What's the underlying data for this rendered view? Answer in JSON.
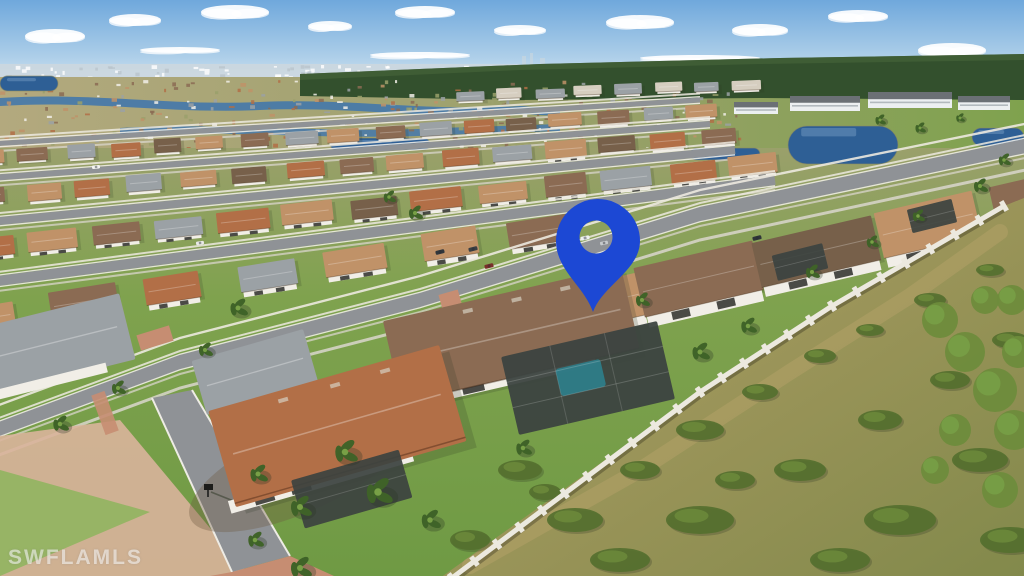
{
  "photo": {
    "description": "Aerial drone photo of a Florida residential community; rows of tile-roof homes, lakes, preserve at right, blue location pin marking the subject home",
    "width": 1024,
    "height": 576
  },
  "watermark": {
    "text": "SWFLAMLS"
  },
  "pin": {
    "label": "location-pin",
    "color": "#1c48d4",
    "cx": 598,
    "cy": 241,
    "r_outer": 42,
    "hole_cx": 596,
    "hole_cy": 237,
    "r_hole": 16.5,
    "tip_x": 593,
    "tip_y": 312
  },
  "palette": {
    "sky_top": "#6fa8dc",
    "sky_mid": "#aecfe9",
    "sky_horizon": "#e6eef3",
    "cloud": "#ffffff",
    "city": "#ccd7de",
    "city_speck_a": "#ffffff",
    "city_speck_b": "#b9c4cc",
    "forest": "#33502d",
    "forest_light": "#48663a",
    "dist_land": "#b3a97e",
    "dist_land2": "#9aa06b",
    "canal": "#4478ab",
    "lake": "#2e5f95",
    "lake_edge": "#8d8a60",
    "condo_wall": "#eceff1",
    "condo_roof": "#6b7075",
    "condo_win": "#9aa2a8",
    "street": "#8f9296",
    "street_far": "#a6a8aa",
    "curb": "#eeece5",
    "sidewalk": "#d9d6cc",
    "grass": "#7fa24e",
    "grass_light": "#97b465",
    "lawn": "#6f9a44",
    "roof_tan": "#c09268",
    "roof_brown": "#8b6b53",
    "roof_gray": "#9ba1a5",
    "roof_terra": "#b26f47",
    "roof_dark": "#77604a",
    "roof_light": "#d6cec0",
    "house_wall": "#f1eee7",
    "wall_white": "#ece9df",
    "window_dark": "#4a4a46",
    "lanai": "#3c4340",
    "pool": "#2e7f8c",
    "paver": "#c68d72",
    "paver_light": "#d9b49b",
    "preserve_tan": "#b3a067",
    "preserve_green": "#82894b",
    "bush": "#55702f",
    "bush2": "#6e8c3c",
    "palm": "#3f6328",
    "palm_light": "#78a046",
    "mulch": "#6d5a43",
    "mailbox": "#1d1d1b",
    "shadow": "#2c3524"
  },
  "scene": {
    "clouds": [
      {
        "x": 55,
        "y": 36,
        "rx": 30,
        "ry": 7
      },
      {
        "x": 135,
        "y": 20,
        "rx": 26,
        "ry": 6
      },
      {
        "x": 235,
        "y": 12,
        "rx": 34,
        "ry": 7
      },
      {
        "x": 330,
        "y": 26,
        "rx": 22,
        "ry": 5
      },
      {
        "x": 425,
        "y": 12,
        "rx": 30,
        "ry": 6
      },
      {
        "x": 520,
        "y": 30,
        "rx": 26,
        "ry": 5
      },
      {
        "x": 640,
        "y": 22,
        "rx": 34,
        "ry": 7
      },
      {
        "x": 760,
        "y": 30,
        "rx": 28,
        "ry": 6
      },
      {
        "x": 858,
        "y": 16,
        "rx": 30,
        "ry": 6
      },
      {
        "x": 952,
        "y": 50,
        "rx": 34,
        "ry": 7
      },
      {
        "x": 700,
        "y": 58,
        "rx": 60,
        "ry": 3
      },
      {
        "x": 420,
        "y": 55,
        "rx": 50,
        "ry": 3
      },
      {
        "x": 180,
        "y": 50,
        "rx": 40,
        "ry": 3
      },
      {
        "x": 880,
        "y": 64,
        "rx": 46,
        "ry": 3
      }
    ],
    "streets": [
      {
        "pts": [
          [
            -10,
            144
          ],
          [
            700,
            100
          ]
        ],
        "w": 5
      },
      {
        "pts": [
          [
            -10,
            178
          ],
          [
            710,
            124
          ]
        ],
        "w": 6
      },
      {
        "pts": [
          [
            -10,
            222
          ],
          [
            735,
            150
          ]
        ],
        "w": 8
      },
      {
        "pts": [
          [
            -10,
            282
          ],
          [
            775,
            180
          ]
        ],
        "w": 10
      },
      {
        "pts": [
          [
            -20,
            436
          ],
          [
            180,
            362
          ],
          [
            420,
            300
          ],
          [
            700,
            214
          ],
          [
            1044,
            142
          ]
        ],
        "w": 14
      }
    ],
    "rows": [
      {
        "x0": -10,
        "y0": 158,
        "x1": 700,
        "y1": 112,
        "n": 17,
        "w": 30,
        "h": 13,
        "colors": [
          "roof_tan",
          "roof_brown",
          "roof_gray",
          "roof_terra",
          "roof_dark",
          "roof_tan",
          "roof_brown",
          "roof_gray"
        ]
      },
      {
        "x0": -10,
        "y0": 196,
        "x1": 720,
        "y1": 136,
        "n": 15,
        "w": 36,
        "h": 16,
        "colors": [
          "roof_brown",
          "roof_tan",
          "roof_terra",
          "roof_gray",
          "roof_tan",
          "roof_dark",
          "roof_terra"
        ]
      },
      {
        "x0": -10,
        "y0": 248,
        "x1": 755,
        "y1": 165,
        "n": 13,
        "w": 46,
        "h": 20,
        "colors": [
          "roof_terra",
          "roof_tan",
          "roof_brown",
          "roof_gray",
          "roof_terra",
          "roof_tan",
          "roof_dark"
        ]
      },
      {
        "x0": -10,
        "y0": 318,
        "x1": 540,
        "y1": 230,
        "n": 7,
        "w": 60,
        "h": 27,
        "colors": [
          "roof_tan",
          "roof_brown",
          "roof_terra",
          "roof_gray",
          "roof_tan"
        ]
      },
      {
        "x0": 470,
        "y0": 332,
        "x1": 1044,
        "y1": 198,
        "n": 6,
        "w": 108,
        "h": 46,
        "colors": [
          "roof_brown",
          "roof_tan",
          "roof_brown",
          "roof_dark",
          "roof_tan",
          "roof_brown"
        ]
      }
    ],
    "gray_row": {
      "x0": 470,
      "y0": 96,
      "x1": 745,
      "y1": 85,
      "n": 8,
      "w": 26,
      "h": 10,
      "colors": [
        "roof_gray",
        "roof_light",
        "roof_gray",
        "roof_light"
      ]
    },
    "condos": [
      {
        "x": 790,
        "y": 96,
        "w": 70,
        "h": 15
      },
      {
        "x": 868,
        "y": 92,
        "w": 84,
        "h": 16
      },
      {
        "x": 958,
        "y": 96,
        "w": 52,
        "h": 14
      },
      {
        "x": 734,
        "y": 102,
        "w": 44,
        "h": 12
      }
    ],
    "lakes": [
      {
        "x": 0,
        "y": 76,
        "w": 58,
        "h": 15
      },
      {
        "x": 788,
        "y": 126,
        "w": 110,
        "h": 38
      },
      {
        "x": 972,
        "y": 128,
        "w": 52,
        "h": 18
      },
      {
        "x": 690,
        "y": 148,
        "w": 70,
        "h": 12
      },
      {
        "x": 330,
        "y": 138,
        "w": 100,
        "h": 12
      }
    ],
    "speckles": {
      "x0": 0,
      "x1": 745,
      "y0": 80,
      "y1": 148,
      "count": 300
    },
    "city_speckles": {
      "x0": 0,
      "x1": 520,
      "y0": 65,
      "y1": 77,
      "count": 80
    },
    "wall_pts": [
      [
        452,
        578
      ],
      [
        700,
        392
      ],
      [
        832,
        306
      ],
      [
        1004,
        206
      ]
    ],
    "preserve_pts": "440,578 700,392 832,306 1004,206 1024,198 1024,578",
    "sand_path_pts": "470,566 640,470 790,372 910,296 1000,232",
    "lanai_cages": [
      {
        "x": 800,
        "y": 262,
        "w": 52,
        "h": 26,
        "rot": -14
      },
      {
        "x": 932,
        "y": 216,
        "w": 46,
        "h": 24,
        "rot": -14
      }
    ],
    "bushes": [
      {
        "x": 520,
        "y": 470,
        "rx": 22,
        "ry": 10
      },
      {
        "x": 575,
        "y": 520,
        "rx": 28,
        "ry": 12
      },
      {
        "x": 640,
        "y": 470,
        "rx": 20,
        "ry": 9
      },
      {
        "x": 700,
        "y": 430,
        "rx": 24,
        "ry": 10
      },
      {
        "x": 760,
        "y": 392,
        "rx": 18,
        "ry": 8
      },
      {
        "x": 820,
        "y": 356,
        "rx": 16,
        "ry": 7
      },
      {
        "x": 870,
        "y": 330,
        "rx": 14,
        "ry": 6
      },
      {
        "x": 930,
        "y": 300,
        "rx": 16,
        "ry": 7
      },
      {
        "x": 990,
        "y": 270,
        "rx": 14,
        "ry": 6
      },
      {
        "x": 700,
        "y": 520,
        "rx": 34,
        "ry": 14
      },
      {
        "x": 800,
        "y": 470,
        "rx": 26,
        "ry": 11
      },
      {
        "x": 880,
        "y": 420,
        "rx": 22,
        "ry": 10
      },
      {
        "x": 950,
        "y": 380,
        "rx": 20,
        "ry": 9
      },
      {
        "x": 1010,
        "y": 340,
        "rx": 18,
        "ry": 8
      },
      {
        "x": 620,
        "y": 560,
        "rx": 30,
        "ry": 12
      },
      {
        "x": 900,
        "y": 520,
        "rx": 36,
        "ry": 15
      },
      {
        "x": 980,
        "y": 460,
        "rx": 28,
        "ry": 12
      },
      {
        "x": 1010,
        "y": 540,
        "rx": 30,
        "ry": 13
      },
      {
        "x": 840,
        "y": 560,
        "rx": 30,
        "ry": 12
      },
      {
        "x": 470,
        "y": 540,
        "rx": 20,
        "ry": 10
      },
      {
        "x": 545,
        "y": 492,
        "rx": 16,
        "ry": 8
      },
      {
        "x": 735,
        "y": 480,
        "rx": 20,
        "ry": 9
      }
    ],
    "trees": [
      {
        "x": 940,
        "y": 320,
        "r": 18
      },
      {
        "x": 965,
        "y": 352,
        "r": 20
      },
      {
        "x": 995,
        "y": 390,
        "r": 22
      },
      {
        "x": 1014,
        "y": 430,
        "r": 20
      },
      {
        "x": 985,
        "y": 300,
        "r": 14
      },
      {
        "x": 1012,
        "y": 300,
        "r": 15
      },
      {
        "x": 1018,
        "y": 352,
        "r": 16
      },
      {
        "x": 955,
        "y": 430,
        "r": 16
      },
      {
        "x": 935,
        "y": 470,
        "r": 14
      },
      {
        "x": 1000,
        "y": 490,
        "r": 18
      }
    ],
    "palms": [
      {
        "x": 238,
        "y": 308,
        "r": 10
      },
      {
        "x": 205,
        "y": 350,
        "r": 8
      },
      {
        "x": 415,
        "y": 213,
        "r": 8
      },
      {
        "x": 389,
        "y": 197,
        "r": 7
      },
      {
        "x": 345,
        "y": 452,
        "r": 13
      },
      {
        "x": 378,
        "y": 492,
        "r": 15
      },
      {
        "x": 300,
        "y": 507,
        "r": 12
      },
      {
        "x": 258,
        "y": 474,
        "r": 10
      },
      {
        "x": 430,
        "y": 520,
        "r": 11
      },
      {
        "x": 523,
        "y": 448,
        "r": 9
      },
      {
        "x": 700,
        "y": 352,
        "r": 10
      },
      {
        "x": 748,
        "y": 326,
        "r": 9
      },
      {
        "x": 642,
        "y": 300,
        "r": 8
      },
      {
        "x": 812,
        "y": 272,
        "r": 8
      },
      {
        "x": 872,
        "y": 242,
        "r": 7
      },
      {
        "x": 918,
        "y": 216,
        "r": 7
      },
      {
        "x": 118,
        "y": 388,
        "r": 8
      },
      {
        "x": 60,
        "y": 424,
        "r": 9
      },
      {
        "x": 880,
        "y": 120,
        "r": 6
      },
      {
        "x": 920,
        "y": 128,
        "r": 6
      },
      {
        "x": 960,
        "y": 118,
        "r": 5
      },
      {
        "x": 1004,
        "y": 160,
        "r": 7
      },
      {
        "x": 980,
        "y": 186,
        "r": 8
      },
      {
        "x": 300,
        "y": 568,
        "r": 12
      },
      {
        "x": 255,
        "y": 540,
        "r": 9
      }
    ],
    "cars": [
      {
        "x": 96,
        "y": 167,
        "c": "#f4f4f2",
        "rot": -6,
        "l": 8,
        "wd": 3.5
      },
      {
        "x": 440,
        "y": 252,
        "c": "#30363b",
        "rot": -14,
        "l": 9,
        "wd": 4
      },
      {
        "x": 473,
        "y": 249,
        "c": "#3a3f44",
        "rot": -14,
        "l": 9,
        "wd": 4
      },
      {
        "x": 489,
        "y": 266,
        "c": "#7a2f2a",
        "rot": -14,
        "l": 9,
        "wd": 4
      },
      {
        "x": 585,
        "y": 238,
        "c": "#eef1f2",
        "rot": -12,
        "l": 9,
        "wd": 4
      },
      {
        "x": 604,
        "y": 243,
        "c": "#c6c9cc",
        "rot": -12,
        "l": 8,
        "wd": 3.5
      },
      {
        "x": 757,
        "y": 238,
        "c": "#2f3438",
        "rot": -14,
        "l": 9,
        "wd": 4
      },
      {
        "x": 200,
        "y": 243,
        "c": "#e9e9e7",
        "rot": -8,
        "l": 8,
        "wd": 3.5
      }
    ]
  }
}
